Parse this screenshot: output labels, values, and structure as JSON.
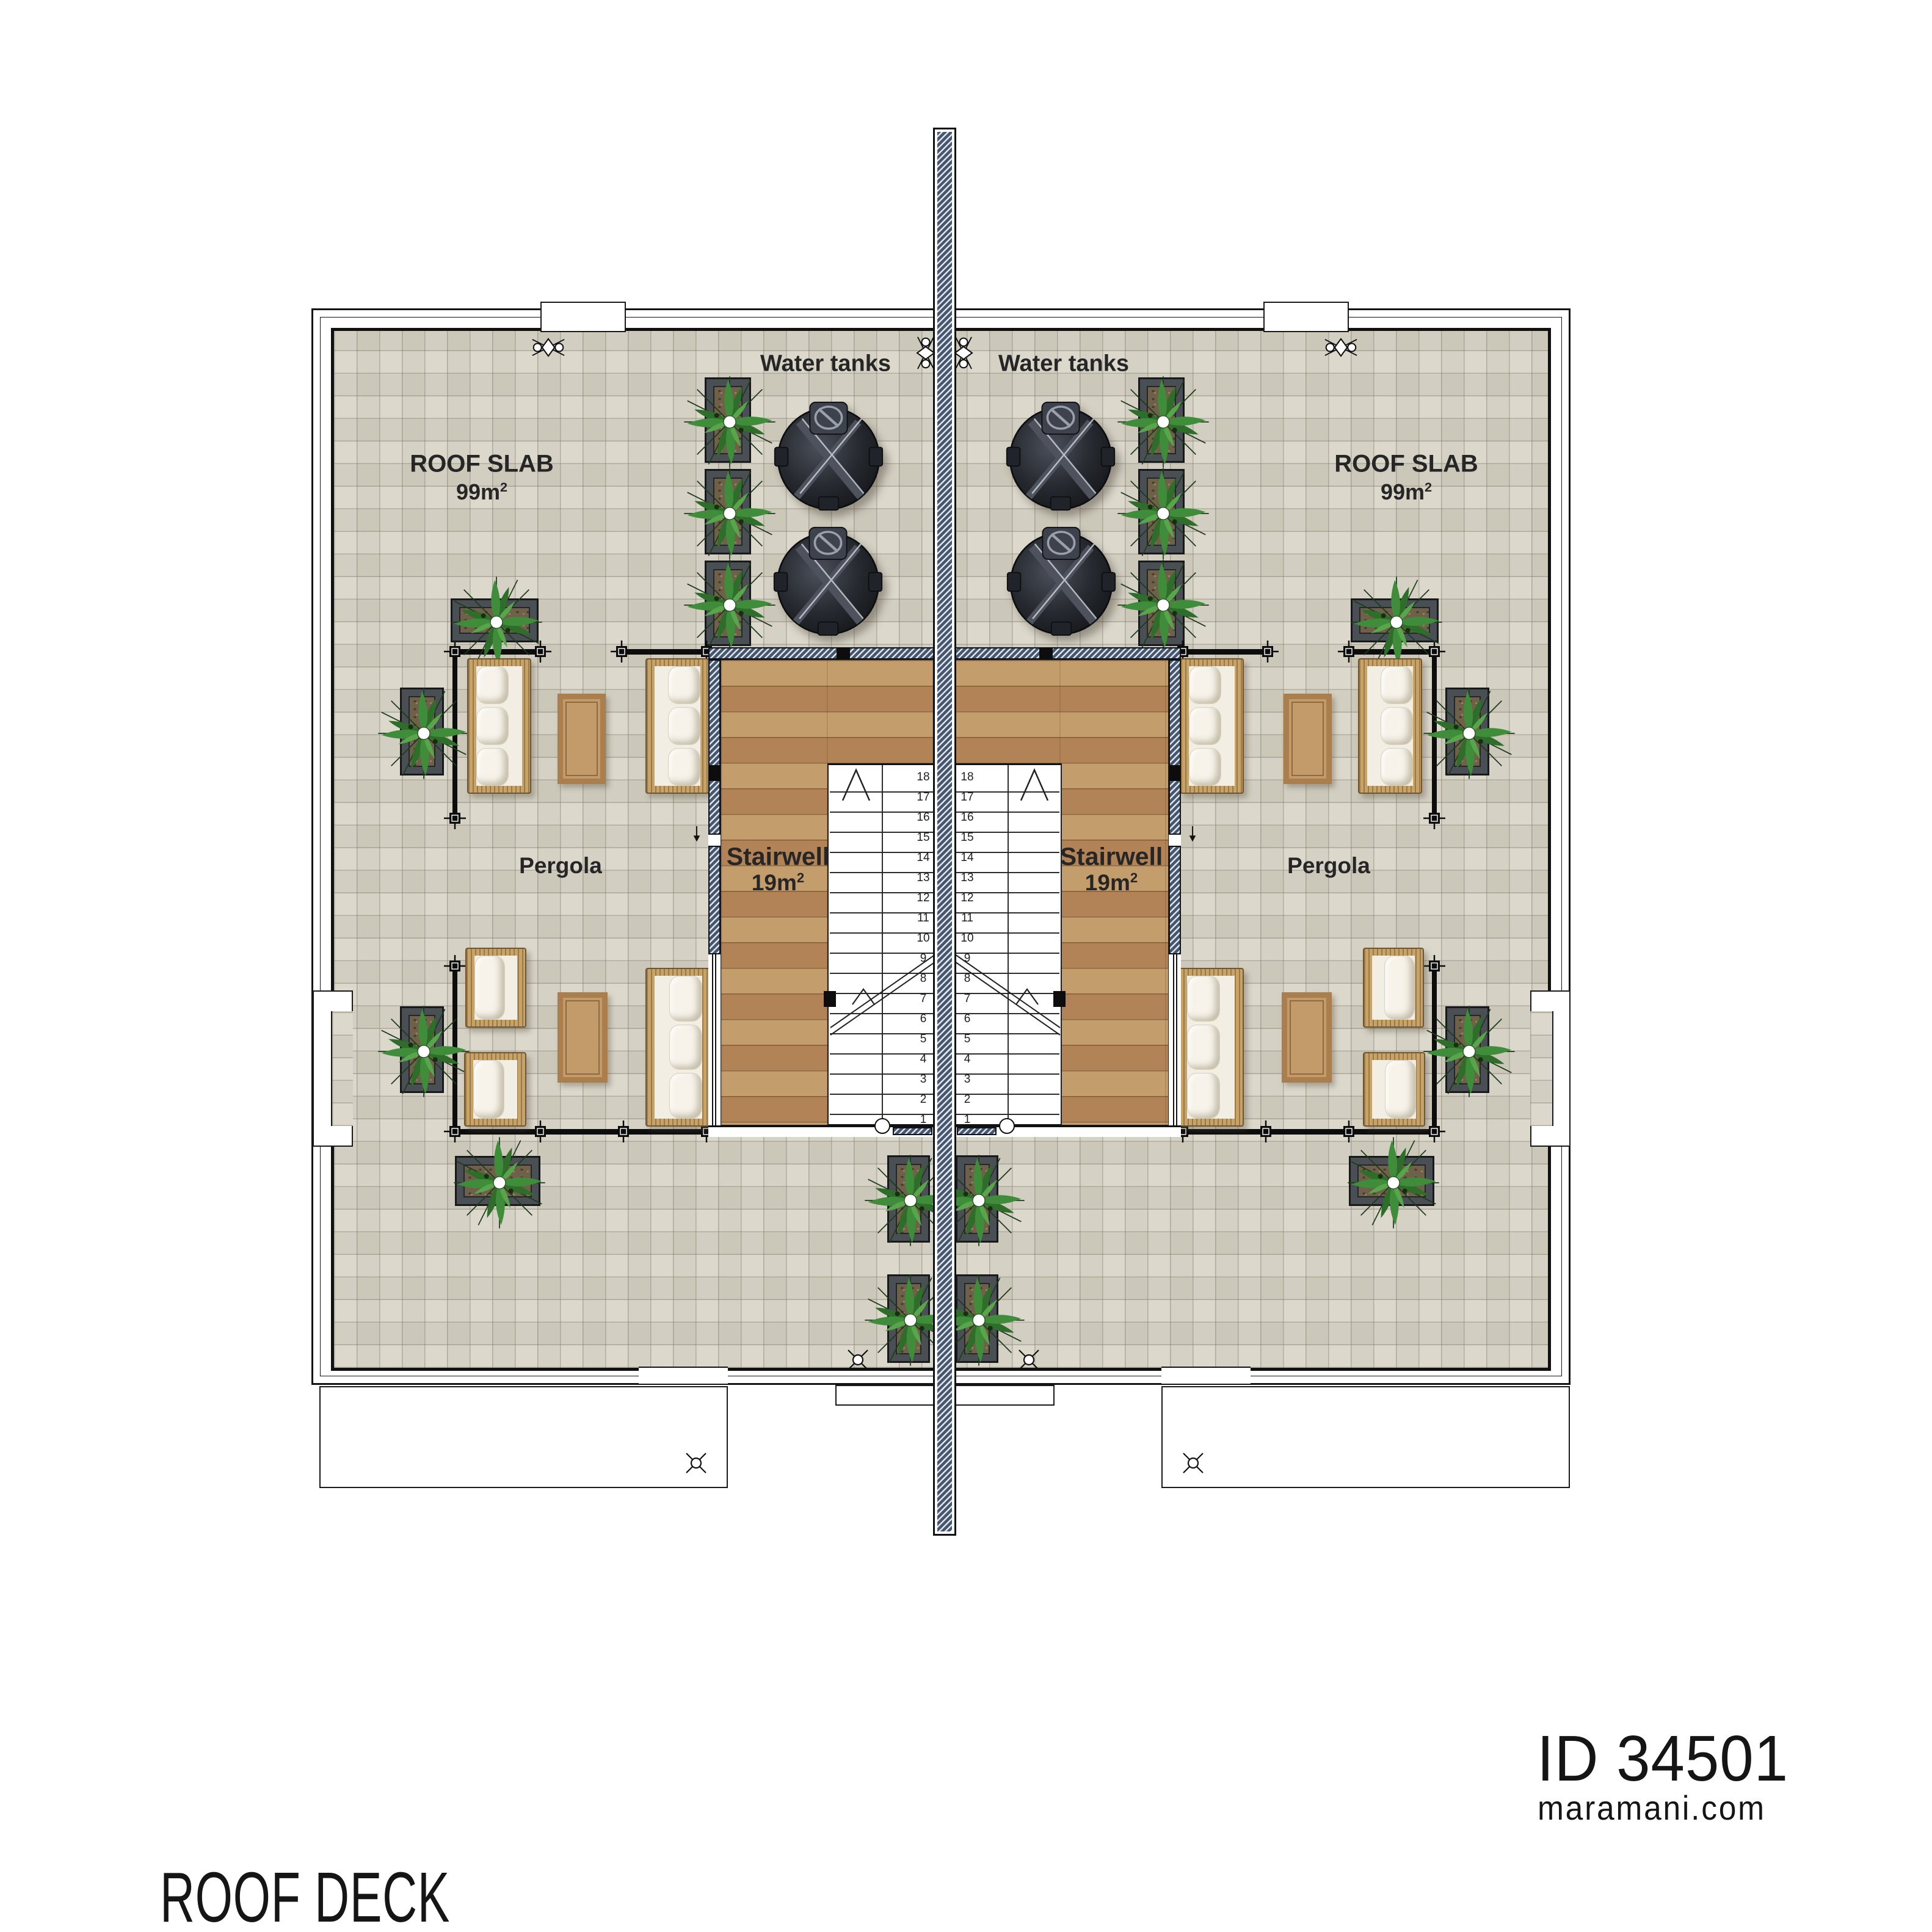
{
  "floor_plan": {
    "labels": {
      "water_tanks": "Water tanks",
      "roof_slab": {
        "title": "ROOF SLAB",
        "area_value": "99m",
        "area_exp": "2"
      },
      "pergola": "Pergola",
      "stairwell": {
        "title": "Stairwell",
        "area_value": "19m",
        "area_exp": "2"
      }
    },
    "stairs": {
      "steps": [
        1,
        2,
        3,
        4,
        5,
        6,
        7,
        8,
        9,
        10,
        11,
        12,
        13,
        14,
        15,
        16,
        17,
        18
      ]
    }
  },
  "title_block": {
    "floor_name": "ROOF DECK",
    "plan_id": "ID 34501",
    "website": "maramani.com"
  },
  "colors": {
    "tile": "#d8d4c6",
    "tile_line": "#b0ab9e",
    "wood": "#b78c5a",
    "wall_hatch": "#46566c",
    "plant_green": "#3f8d3a",
    "wicker": "#c7a368",
    "cushion": "#f2eee3",
    "table": "#c39a6a",
    "tank": "#23262c",
    "text": "#262626"
  }
}
